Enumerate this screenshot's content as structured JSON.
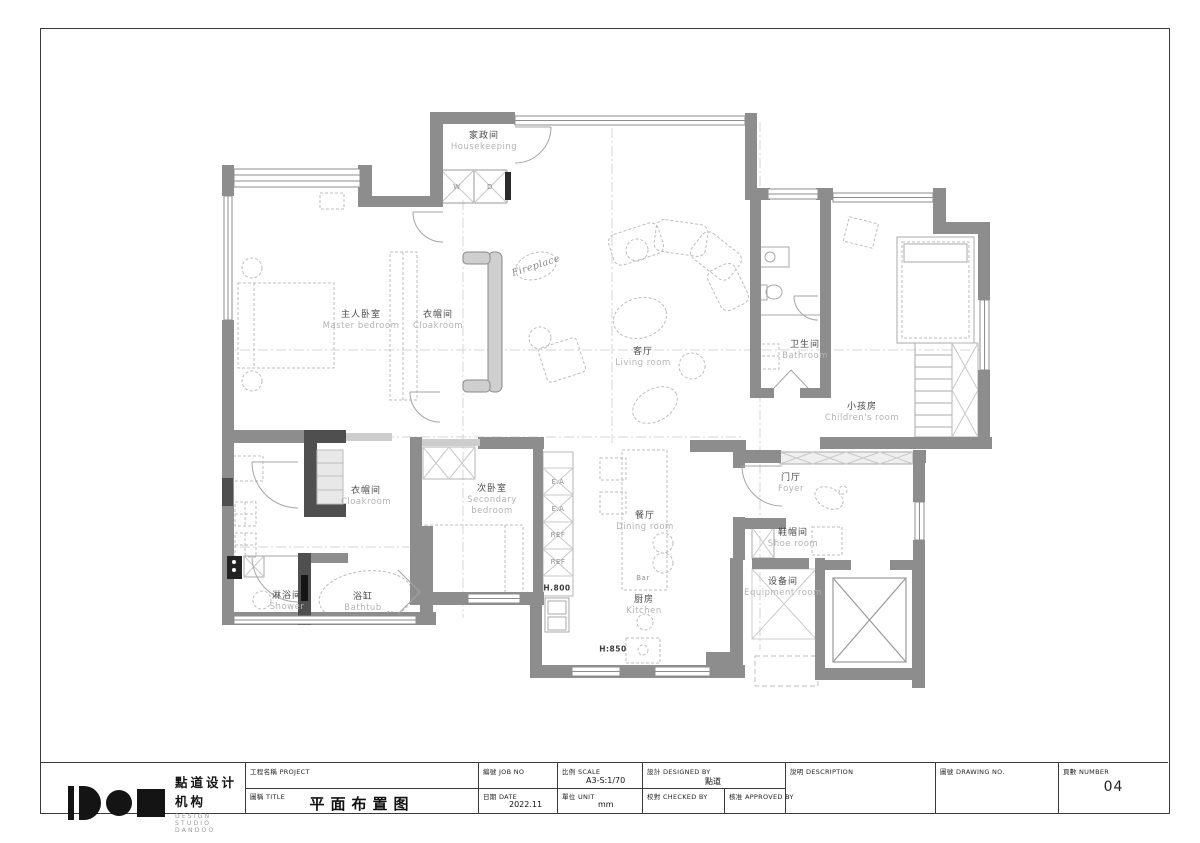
{
  "title_block": {
    "logo": {
      "cn": "點道设计机构",
      "en": "DESIGN STUDIO DANDOO"
    },
    "project": {
      "label": "工程名稱 PROJECT",
      "value": ""
    },
    "title": {
      "label": "圖稱 TITLE",
      "value": "平面布置图"
    },
    "job_no": {
      "label": "編號 JOB NO",
      "value": ""
    },
    "date": {
      "label": "日期 DATE",
      "value": "2022.11"
    },
    "scale": {
      "label": "比例 SCALE",
      "value": "A3-S:1/70"
    },
    "unit": {
      "label": "單位 UNIT",
      "value": "mm"
    },
    "designed_by": {
      "label": "設計 DESIGNED BY",
      "value": "點道"
    },
    "checked_by": {
      "label": "校對 CHECKED BY",
      "value": ""
    },
    "approved_by": {
      "label": "核准 APPROVED BY",
      "value": ""
    },
    "description": {
      "label": "說明 DESCRIPTION",
      "value": ""
    },
    "drawing_no": {
      "label": "圖號 DRAWING NO.",
      "value": ""
    },
    "number": {
      "label": "頁數 NUMBER",
      "value": "04"
    }
  },
  "rooms": {
    "housekeeping": {
      "zh": "家政间",
      "en": "Housekeeping"
    },
    "master_bedroom": {
      "zh": "主人卧室",
      "en": "Master bedroom"
    },
    "cloakroom_master": {
      "zh": "衣帽间",
      "en": "Cloakroom"
    },
    "living_room": {
      "zh": "客厅",
      "en": "Living room"
    },
    "bathroom": {
      "zh": "卫生间",
      "en": "Bathroom"
    },
    "childrens_room": {
      "zh": "小孩房",
      "en": "Children's room"
    },
    "foyer": {
      "zh": "门厅",
      "en": "Foyer"
    },
    "shoe_room": {
      "zh": "鞋帽间",
      "en": "Shoe room"
    },
    "equipment_room": {
      "zh": "设备间",
      "en": "Equipment room"
    },
    "cloakroom_second": {
      "zh": "衣帽间",
      "en": "Cloakroom"
    },
    "secondary_bedroom": {
      "zh": "次卧室",
      "en": "Secondary bedroom"
    },
    "shower": {
      "zh": "淋浴间",
      "en": "Shower"
    },
    "bathtub": {
      "zh": "浴缸",
      "en": "Bathtub"
    },
    "dining_room": {
      "zh": "餐厅",
      "en": "Dining room"
    },
    "kitchen": {
      "zh": "厨房",
      "en": "Kitchen"
    }
  },
  "annotations": {
    "fireplace": "Fireplace",
    "washer": "W",
    "dryer": "D",
    "ea": "E.A",
    "ref": "REF",
    "counter_height": "H.800",
    "island_height": "H:850",
    "bar": "Bar"
  }
}
